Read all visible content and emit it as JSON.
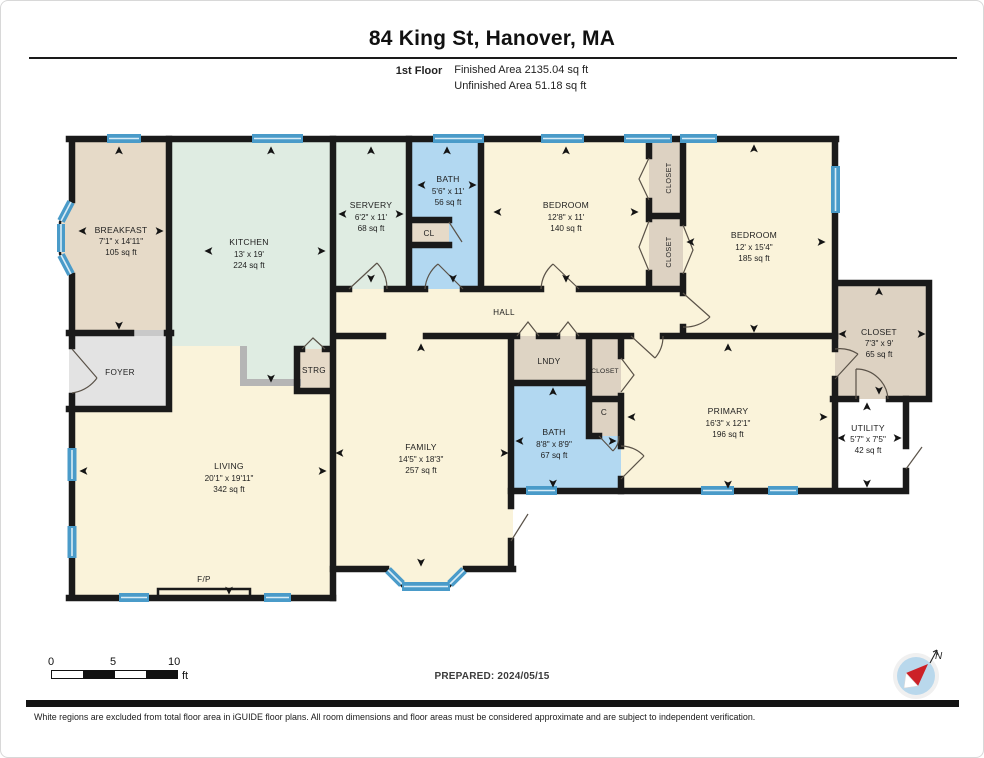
{
  "header": {
    "title": "84 King St, Hanover, MA",
    "floor_label": "1st Floor",
    "finished_area": "Finished Area 2135.04 sq ft",
    "unfinished_area": "Unfinished Area 51.18 sq ft"
  },
  "rooms": {
    "breakfast": {
      "name": "BREAKFAST",
      "dims": "7'1\" x 14'11\"",
      "area": "105 sq ft"
    },
    "kitchen": {
      "name": "KITCHEN",
      "dims": "13' x 19'",
      "area": "224 sq ft"
    },
    "servery": {
      "name": "SERVERY",
      "dims": "6'2\" x 11'",
      "area": "68 sq ft"
    },
    "bath1": {
      "name": "BATH",
      "dims": "5'6\" x 11'",
      "area": "56 sq ft"
    },
    "cl": {
      "name": "CL"
    },
    "bedroom1": {
      "name": "BEDROOM",
      "dims": "12'8\" x 11'",
      "area": "140 sq ft"
    },
    "closet_top": {
      "name": "CLOSET"
    },
    "closet_bottom": {
      "name": "CLOSET"
    },
    "bedroom2": {
      "name": "BEDROOM",
      "dims": "12' x 15'4\"",
      "area": "185 sq ft"
    },
    "hall": {
      "name": "HALL"
    },
    "foyer": {
      "name": "FOYER"
    },
    "strg": {
      "name": "STRG"
    },
    "living": {
      "name": "LIVING",
      "dims": "20'1\" x 19'11\"",
      "area": "342 sq ft"
    },
    "fp": {
      "name": "F/P"
    },
    "family": {
      "name": "FAMILY",
      "dims": "14'5\" x 18'3\"",
      "area": "257 sq ft"
    },
    "lndy": {
      "name": "LNDY"
    },
    "closet_mid": {
      "name": "CLOSET"
    },
    "c": {
      "name": "C"
    },
    "bath2": {
      "name": "BATH",
      "dims": "8'8\" x 8'9\"",
      "area": "67 sq ft"
    },
    "primary": {
      "name": "PRIMARY",
      "dims": "16'3\" x 12'1\"",
      "area": "196 sq ft"
    },
    "closet_right": {
      "name": "CLOSET",
      "dims": "7'3\" x 9'",
      "area": "65 sq ft"
    },
    "utility": {
      "name": "UTILITY",
      "dims": "5'7\" x 7'5\"",
      "area": "42 sq ft"
    }
  },
  "scale_bar": {
    "tick0": "0",
    "tick5": "5",
    "tick10": "10",
    "unit": "ft"
  },
  "compass": {
    "label": "N"
  },
  "footer": {
    "prepared": "PREPARED: 2024/05/15",
    "disclaimer": "White regions are excluded from total floor area in iGUIDE floor plans. All room dimensions and floor areas must be considered approximate and are subject to independent verification."
  },
  "colors": {
    "cream": "#faf3da",
    "green": "#dfece2",
    "tan": "#e6dac8",
    "closet_tan": "#ddd2c2",
    "bath_blue": "#b2d8f1",
    "foyer_gray": "#e3e3e3",
    "window_blue": "#4a9bc9",
    "wall": "#1a1a1a"
  }
}
